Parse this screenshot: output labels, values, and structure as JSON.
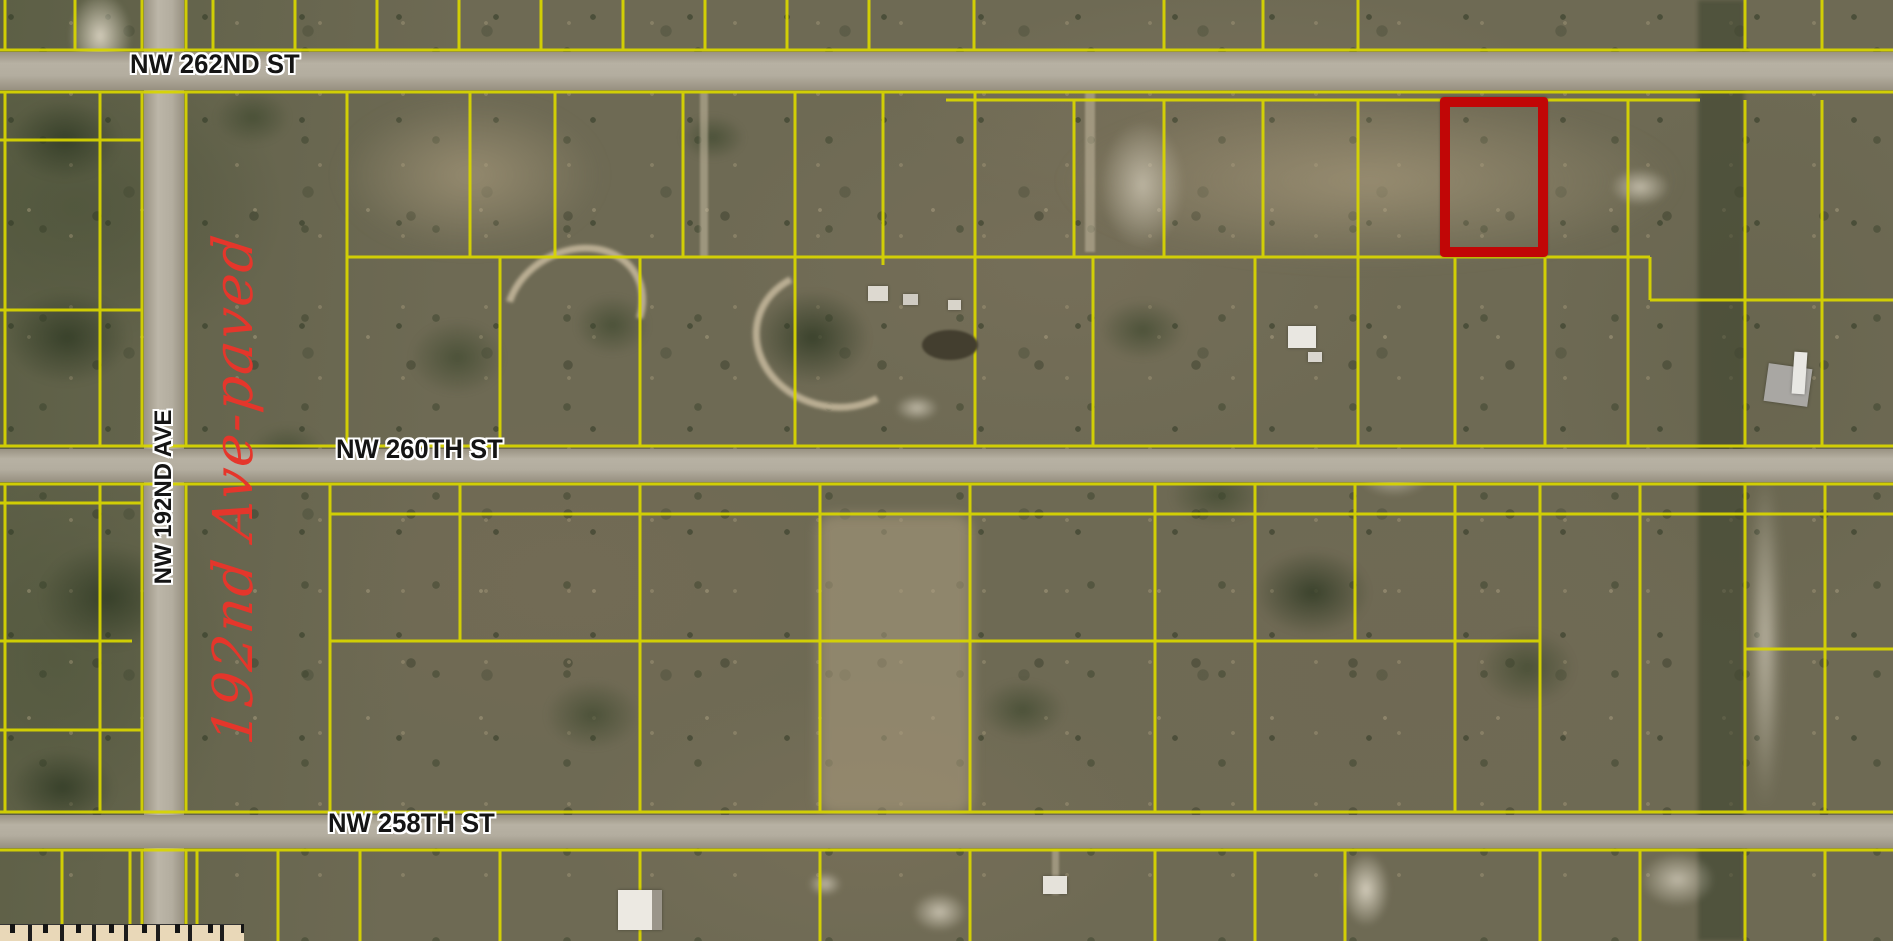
{
  "map": {
    "description": "Aerial satellite parcel map with yellow lot boundary lines",
    "streets": [
      {
        "name": "NW 262ND ST",
        "orientation": "horizontal"
      },
      {
        "name": "NW 260TH ST",
        "orientation": "horizontal"
      },
      {
        "name": "NW 258TH ST",
        "orientation": "horizontal"
      },
      {
        "name": "NW 192ND AVE",
        "orientation": "vertical"
      }
    ],
    "annotation": {
      "text": "192nd Ave-paved",
      "color": "#e5362b",
      "style": "handwritten, rotated vertical, reads bottom to top"
    },
    "highlight_parcel": {
      "shape": "rectangle",
      "color": "#c10606",
      "meaning": "subject parcel outlined in red"
    },
    "colors": {
      "parcel_line": "#d9d600",
      "road_surface": "#b3ad9f",
      "label_text": "#141414",
      "label_halo": "#ffffff",
      "terrain_base": "#6e6a54"
    }
  }
}
